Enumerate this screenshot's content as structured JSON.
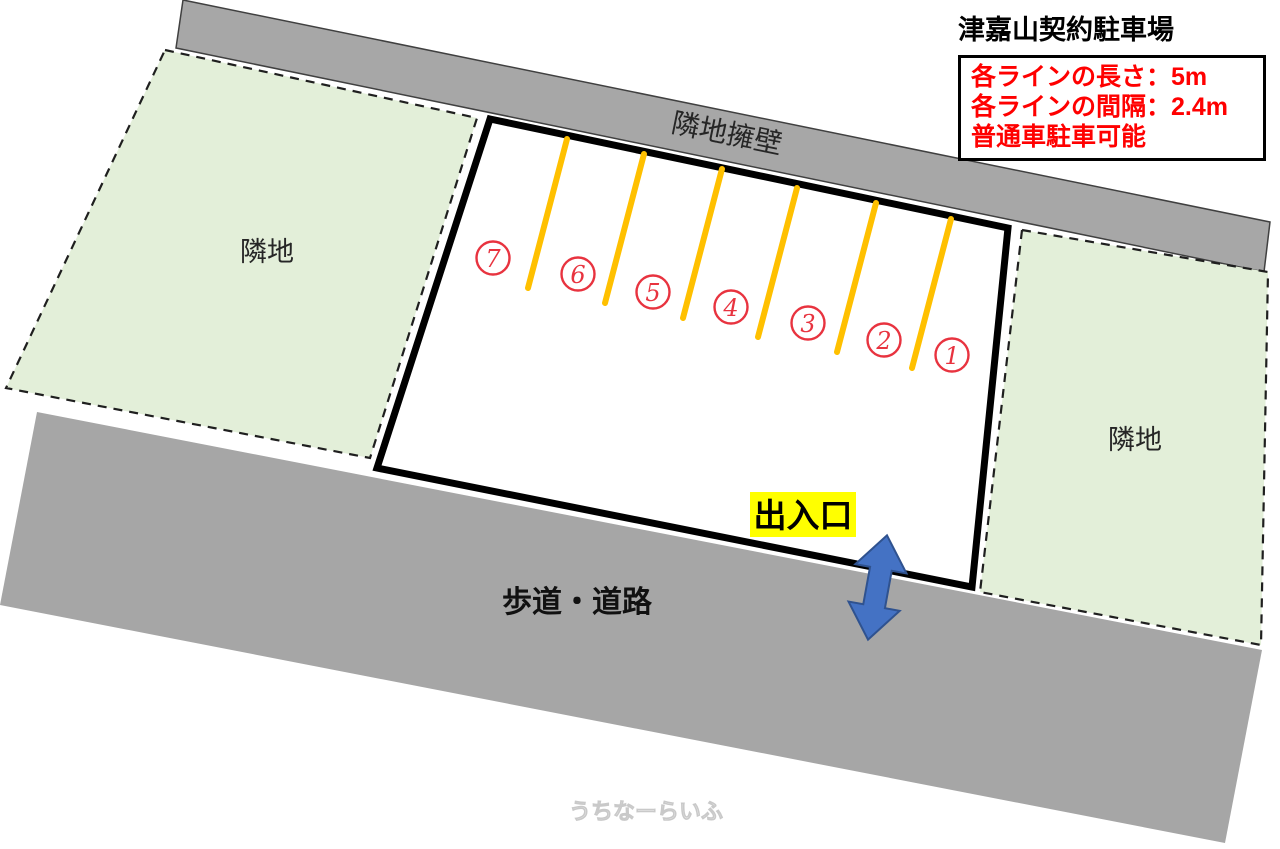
{
  "title": "津嘉山契約駐車場",
  "info_box": {
    "lines": [
      "各ラインの長さ：5m",
      "各ラインの間隔：2.4m",
      "普通車駐車可能"
    ]
  },
  "labels": {
    "retaining_wall": "隣地擁壁",
    "adjacent_lot_left": "隣地",
    "adjacent_lot_right": "隣地",
    "road": "歩道・道路",
    "entrance": "出入口",
    "watermark": "うちなーらいふ"
  },
  "stall_numbers": [
    "7",
    "6",
    "5",
    "4",
    "3",
    "2",
    "1"
  ],
  "spec": {
    "line_length": "5m",
    "line_spacing": "2.4m",
    "vehicle_note": "普通車駐車可能"
  },
  "colors": {
    "wall_gray": "#a7a7a7",
    "road_gray": "#a6a6a6",
    "adjacent_green": "#e3efd9",
    "parking_line_gold": "#ffc000",
    "stall_number_red": "#e8333f",
    "info_text_red": "#ff0000",
    "entrance_highlight_yellow": "#ffff00",
    "arrow_blue": "#4472c4",
    "arrow_border_blue": "#2f528f",
    "lot_border_black": "#000000"
  }
}
